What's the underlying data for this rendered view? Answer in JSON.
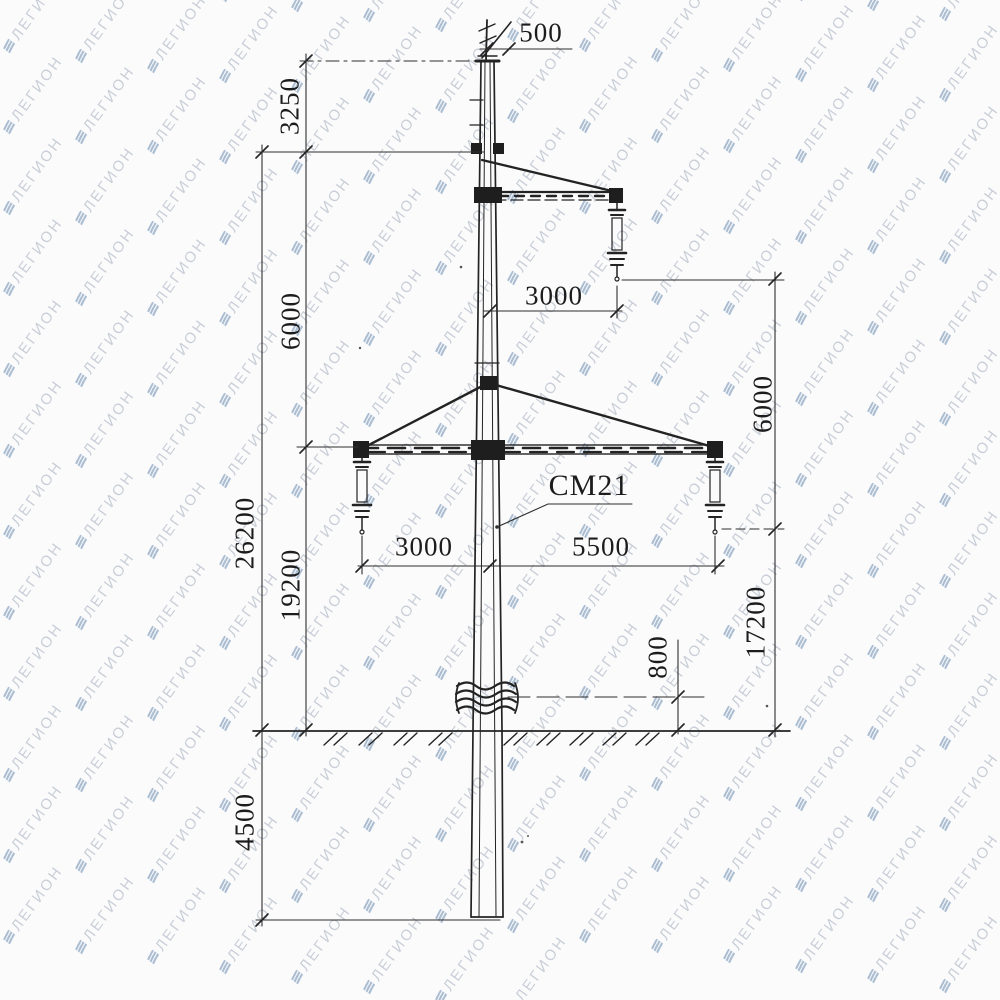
{
  "watermark": {
    "text": "ЛЕГИОН",
    "text_color": "#bdc4ce",
    "icon_color": "#9db2c9"
  },
  "drawing": {
    "part_label": "СМ21",
    "line_color": "#232323",
    "dims": {
      "top_offset": "500",
      "top_to_upper_crossarm": "3250",
      "upper_to_lower_crossarm": "6000",
      "upper_wire_offset": "3000",
      "upper_to_lower_wire": "6000",
      "lower_wire_offset_left": "3000",
      "lower_wire_offset_right": "5500",
      "total_height_above_ground": "26200",
      "lower_crossarm_height": "19200",
      "lower_wire_height": "17200",
      "joint_above_ground": "800",
      "embedment_depth": "4500"
    }
  }
}
